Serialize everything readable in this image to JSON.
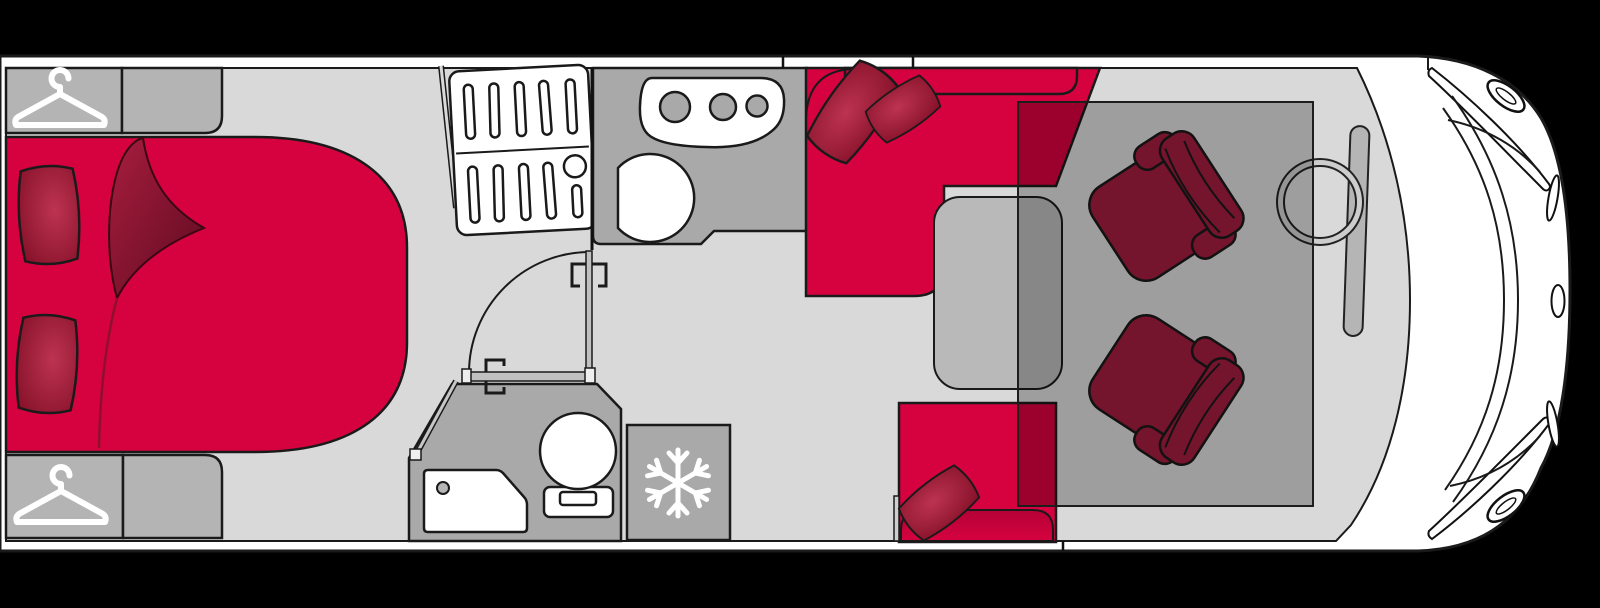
{
  "app": {
    "name": "Motorhome floor plan",
    "description": "Top-down floor plan diagram of a motorhome: driver cab at the front (right), lounge with L-shaped dinette and swivel cab seats under a drop-down bed, kitchen block with 3-burner hob and round sink, bathroom with shower and toilet, refrigerator, and a rear bedroom (left) with bed, pillows and wardrobes"
  },
  "colors": {
    "background": "#000000",
    "body": "#ffffff",
    "outline": "#1a1a1a",
    "floor": "#d9d9d9",
    "cabinet": "#b4b4b4",
    "counter": "#a9a9a9",
    "fixture": "#ffffff",
    "table": "#b9b9b9",
    "dashboard": "#b5b5b5",
    "wheel_ring": "#cdcdcd",
    "upholstery": "#d6023f",
    "upholstery_dark": "#a01c3e",
    "pillow_light": "#bd3352",
    "pillow_dark": "#841027",
    "fold_dark": "#6d0e24",
    "overlay": "rgba(0,0,0,0.27)"
  },
  "areas": [
    {
      "id": "bedroom",
      "label": "Rear bedroom",
      "features": [
        "double bed with turned-down quilt",
        "2 pillows",
        "wardrobe top",
        "wardrobe bottom"
      ]
    },
    {
      "id": "entry",
      "label": "Entry with louvered cabinet door",
      "features": [
        "slatted double door",
        "open thin door panel"
      ]
    },
    {
      "id": "kitchen",
      "label": "Kitchen block",
      "features": [
        "3-burner hob",
        "round sink"
      ]
    },
    {
      "id": "bathroom",
      "label": "Washroom",
      "features": [
        "folding door with swing arc",
        "towel rail",
        "shower tray with drain",
        "toilet"
      ]
    },
    {
      "id": "fridge",
      "label": "Refrigerator / freezer",
      "icon": "snowflake-icon"
    },
    {
      "id": "lounge",
      "label": "Lounge / dinette",
      "features": [
        "L-shaped sofa bench with 2 cushions",
        "side bench with cushion",
        "pedestal table",
        "drop-down bed overlay"
      ]
    },
    {
      "id": "cab",
      "label": "Driver cab",
      "features": [
        "driver swivel seat",
        "passenger swivel seat",
        "steering wheel",
        "dashboard",
        "windscreen",
        "wing mirrors",
        "headlights"
      ]
    }
  ],
  "icons": [
    {
      "name": "hanger-icon",
      "meaning": "wardrobe"
    },
    {
      "name": "snowflake-icon",
      "meaning": "refrigerator / freezer"
    }
  ],
  "orientation": {
    "front_of_vehicle": "right",
    "rear_of_vehicle": "left"
  }
}
